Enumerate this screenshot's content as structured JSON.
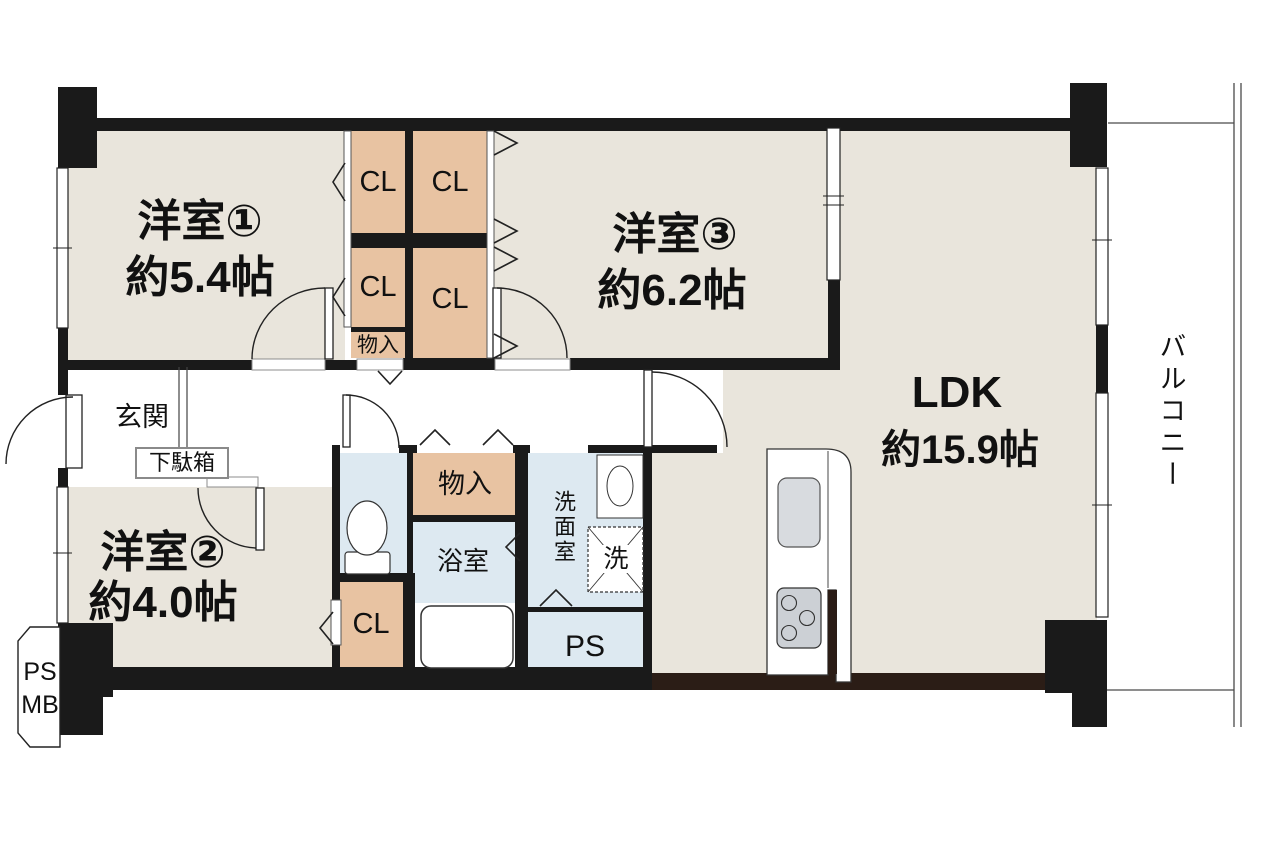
{
  "title": "マンション間取り図 3LDK",
  "rooms": {
    "room1": {
      "name": "洋室①",
      "size": "約5.4帖"
    },
    "room2": {
      "name": "洋室②",
      "size": "約4.0帖"
    },
    "room3": {
      "name": "洋室③",
      "size": "約6.2帖"
    },
    "ldk": {
      "name": "LDK",
      "size": "約15.9帖"
    },
    "entrance": {
      "name": "玄関"
    },
    "bathroom": {
      "name": "浴室"
    },
    "washroom": {
      "name": "洗面室"
    },
    "balcony": {
      "name": "バルコニー"
    }
  },
  "labels": {
    "closet": "CL",
    "storage": "物入",
    "shoe_cabinet": "下駄箱",
    "washer": "洗",
    "pipe_space": "PS",
    "meter_box": "MB"
  },
  "colors": {
    "wall": "#1a1a1a",
    "wall_wood": "#2b1d16",
    "floor_room": "#e9e5dc",
    "closet_fill": "#e8c3a2",
    "wet_area_fill": "#dde9f1",
    "fixture_gray": "#d6dade"
  }
}
